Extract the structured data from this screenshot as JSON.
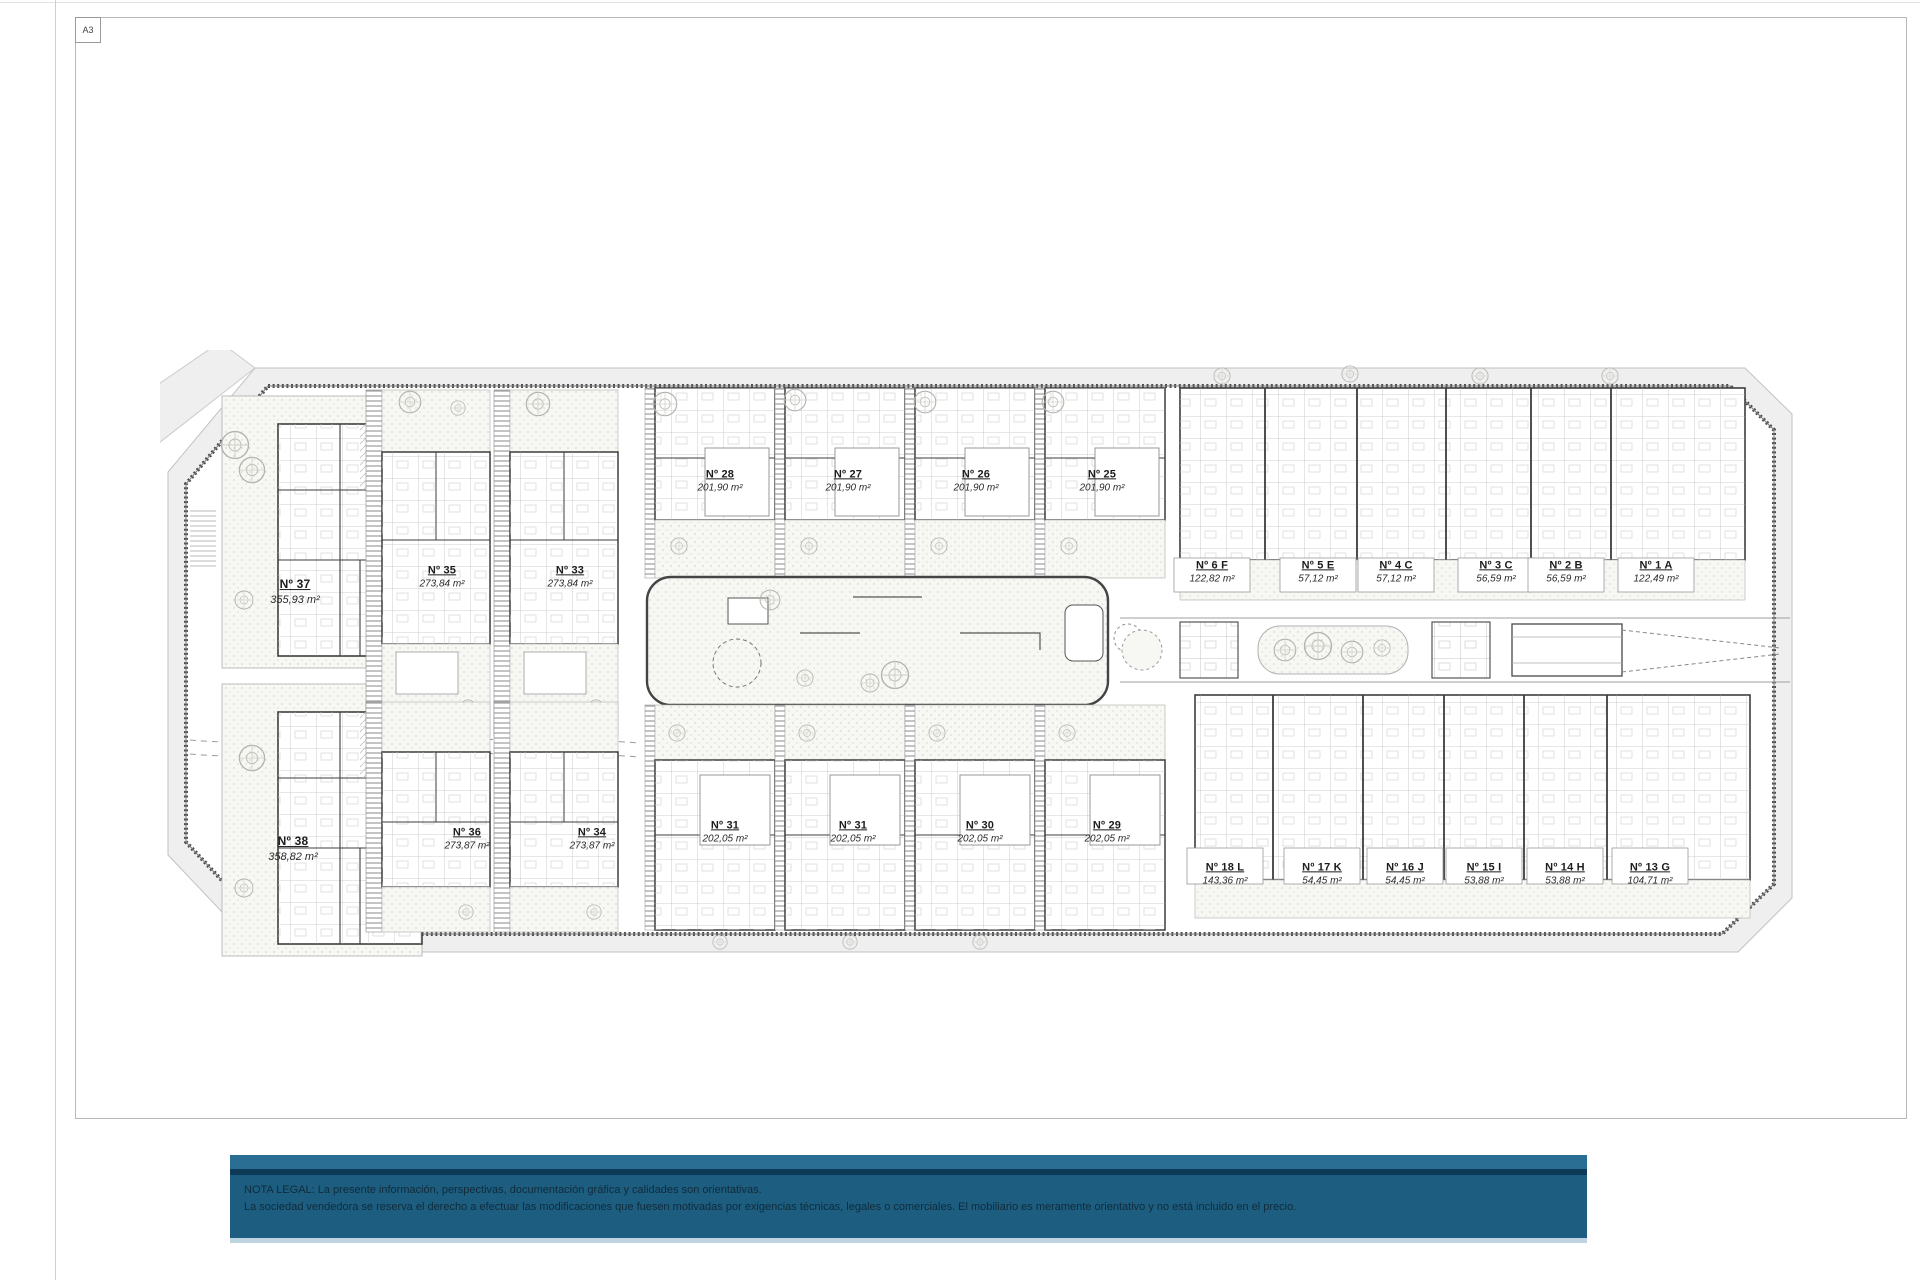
{
  "sheet": {
    "format_label": "A3"
  },
  "plan": {
    "units": [
      {
        "number": "Nº 37",
        "area": "355,93 m²"
      },
      {
        "number": "Nº 35",
        "area": "273,84 m²"
      },
      {
        "number": "Nº 33",
        "area": "273,84 m²"
      },
      {
        "number": "Nº 28",
        "area": "201,90 m²"
      },
      {
        "number": "Nº 27",
        "area": "201,90 m²"
      },
      {
        "number": "Nº 26",
        "area": "201,90 m²"
      },
      {
        "number": "Nº 25",
        "area": "201,90 m²"
      },
      {
        "number": "Nº 6 F",
        "area": "122,82 m²"
      },
      {
        "number": "Nº 5 E",
        "area": "57,12 m²"
      },
      {
        "number": "Nº 4 C",
        "area": "57,12 m²"
      },
      {
        "number": "Nº 3 C",
        "area": "56,59 m²"
      },
      {
        "number": "Nº 2 B",
        "area": "56,59 m²"
      },
      {
        "number": "Nº 1 A",
        "area": "122,49 m²"
      },
      {
        "number": "Nº 38",
        "area": "358,82 m²"
      },
      {
        "number": "Nº 36",
        "area": "273,87 m²"
      },
      {
        "number": "Nº 34",
        "area": "273,87 m²"
      },
      {
        "number": "Nº 31",
        "area": "202,05 m²"
      },
      {
        "number": "Nº 31",
        "area": "202,05 m²"
      },
      {
        "number": "Nº 30",
        "area": "202,05 m²"
      },
      {
        "number": "Nº 29",
        "area": "202,05 m²"
      },
      {
        "number": "Nº 18 L",
        "area": "143,36 m²"
      },
      {
        "number": "Nº 17 K",
        "area": "54,45 m²"
      },
      {
        "number": "Nº 16 J",
        "area": "54,45 m²"
      },
      {
        "number": "Nº 15 I",
        "area": "53,88 m²"
      },
      {
        "number": "Nº 14 H",
        "area": "53,88 m²"
      },
      {
        "number": "Nº 13 G",
        "area": "104,71 m²"
      }
    ]
  },
  "legal": {
    "line1": "NOTA LEGAL: La presente información, perspectivas, documentación gráfica y calidades son orientativas.",
    "line2": "La sociedad vendedora se reserva el derecho a efectuar las modificaciones que fuesen motivadas por exigencias técnicas, legales o comerciales. El mobiliario es meramente orientativo y no está incluido en el precio."
  },
  "colors": {
    "banner_bg": "#1d5d80",
    "banner_top_band": "#2a6e94",
    "banner_dark_stripe": "#0d3a56",
    "banner_bottom_strip": "#bdd3e0",
    "banner_text": "#102b3a",
    "plan_line": "#3d3d3d",
    "sidewalk": "#efeff0"
  }
}
